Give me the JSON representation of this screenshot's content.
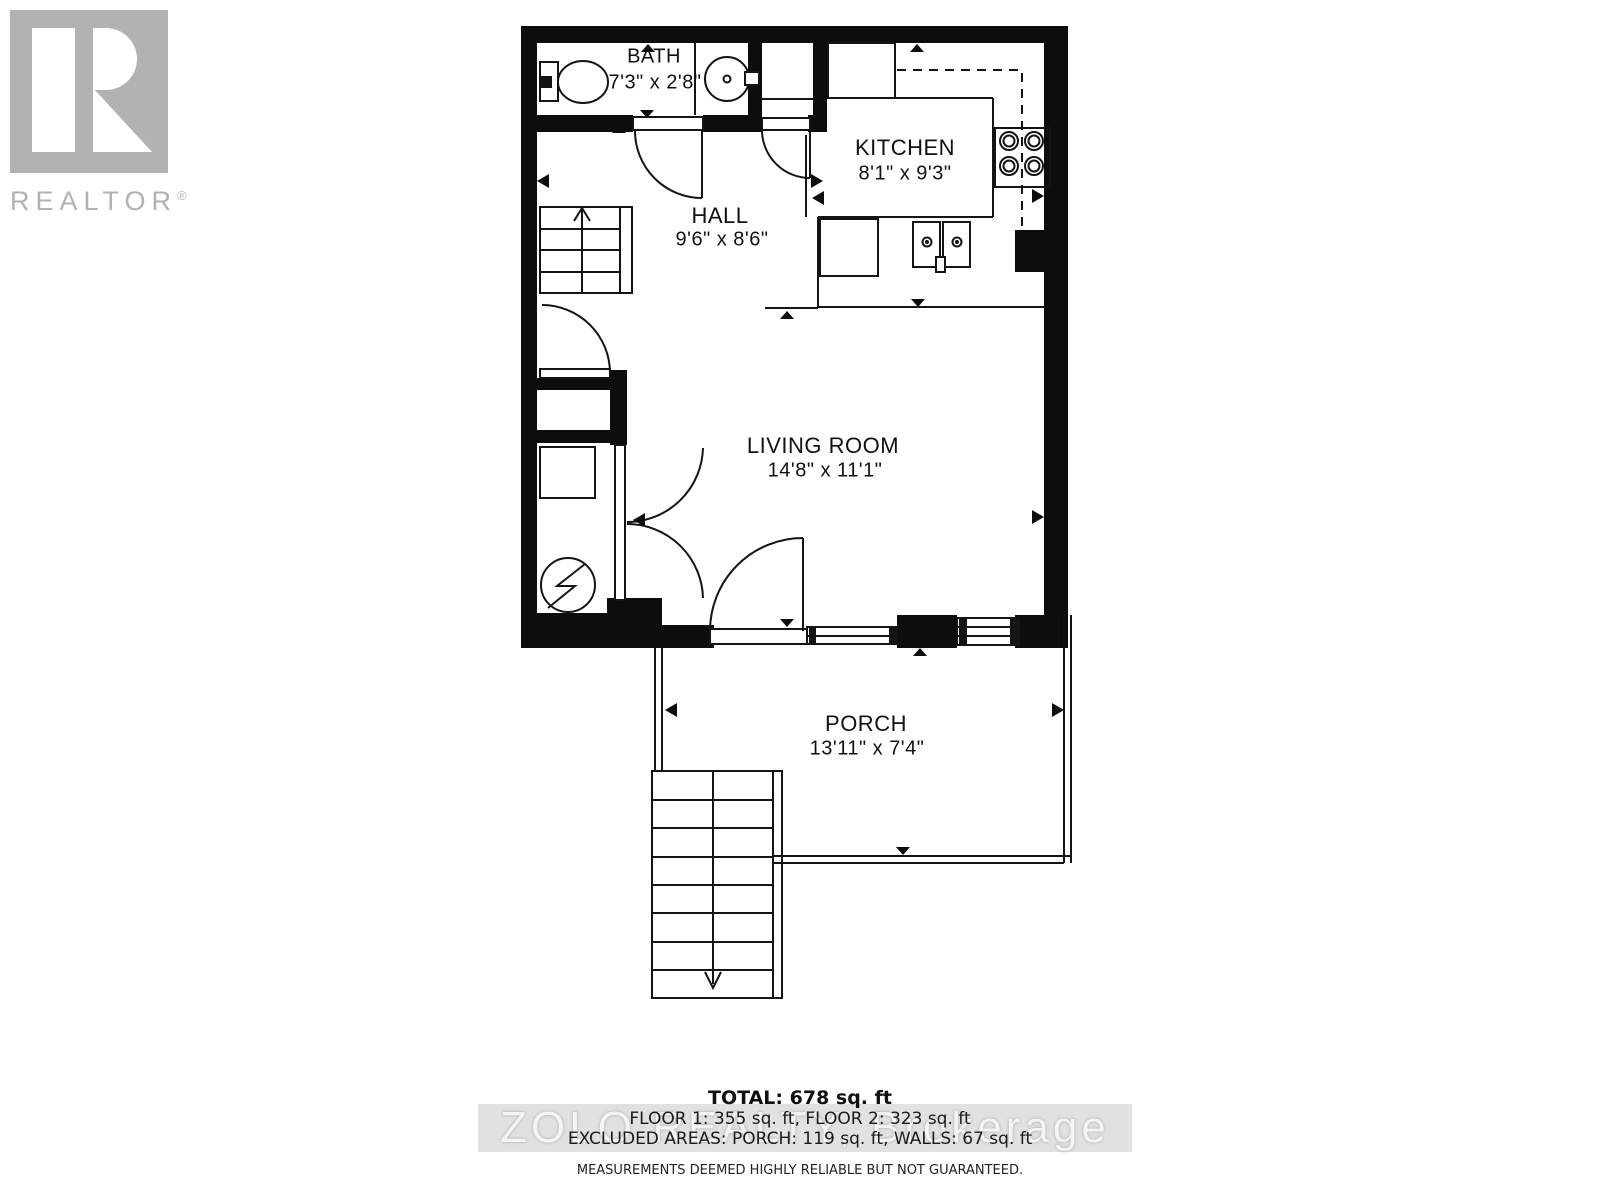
{
  "branding": {
    "logo_text": "REALTOR",
    "registered": "®",
    "logo_color": "#b2b2b2"
  },
  "watermark": "ZOLO REALTY, Brokerage",
  "rooms": [
    {
      "id": "bath",
      "name": "BATH",
      "dimensions": "7'3\" x 2'8\""
    },
    {
      "id": "kitchen",
      "name": "KITCHEN",
      "dimensions": "8'1\" x 9'3\""
    },
    {
      "id": "hall",
      "name": "HALL",
      "dimensions": "9'6\" x 8'6\""
    },
    {
      "id": "living_room",
      "name": "LIVING ROOM",
      "dimensions": "14'8\" x 11'1\""
    },
    {
      "id": "porch",
      "name": "PORCH",
      "dimensions": "13'11\" x 7'4\""
    }
  ],
  "summary": {
    "total": "TOTAL: 678 sq. ft",
    "floors": "FLOOR 1: 355 sq. ft, FLOOR 2: 323 sq. ft",
    "excluded": "EXCLUDED AREAS: PORCH: 119 sq. ft, WALLS: 67 sq. ft",
    "disclaimer": "MEASUREMENTS DEEMED HIGHLY RELIABLE BUT NOT GUARANTEED."
  },
  "fixtures": [
    "toilet",
    "bathroom-sink",
    "fridge",
    "stove-4-burner",
    "double-sink",
    "dishwasher",
    "electrical-panel",
    "stairs-up",
    "stairs-down",
    "french-doors",
    "entry-door",
    "windows"
  ],
  "colors": {
    "wall": "#0d0d0d",
    "line": "#141414",
    "watermark": "#e1e1e1"
  }
}
